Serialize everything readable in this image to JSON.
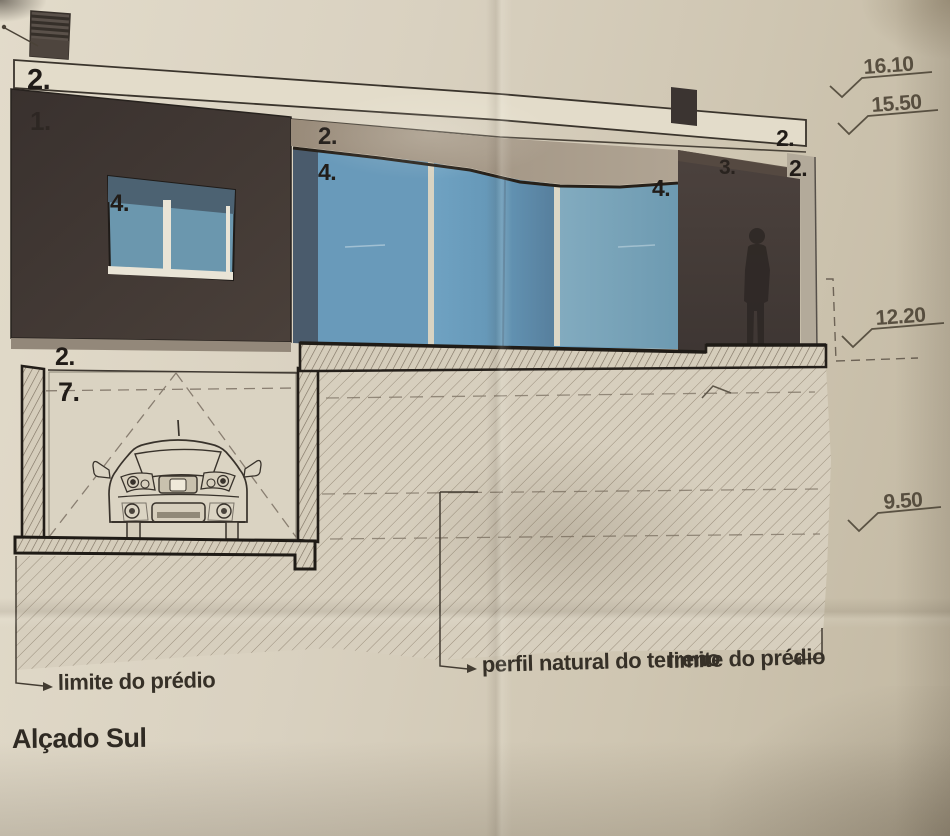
{
  "drawing": {
    "title": "Alçado Sul",
    "legend_labels": {
      "parapet_top": "2.",
      "facade": "1.",
      "window_small": "4.",
      "band_mid": "2.",
      "glazing_left": "4.",
      "glazing_right": "4.",
      "wall_right": "3.",
      "parapet_right": "2.",
      "edge_band_right": "2.",
      "garage_slab": "2.",
      "garage_room": "7."
    },
    "elevations": [
      {
        "value": "16.10"
      },
      {
        "value": "15.50"
      },
      {
        "value": "12.20"
      },
      {
        "value": "9.50"
      }
    ],
    "site_labels": {
      "boundary_left": "limite do prédio",
      "terrain_profile": "perfil natural do terreno",
      "boundary_right": "limite do prédio"
    },
    "colors": {
      "paper": "#d8d0bf",
      "facade_dark": "#3e3632",
      "glass_blue": "#6096b8",
      "band_tan": "#a39584",
      "hatch_line": "#9a8e7c",
      "ink": "#26211c"
    }
  }
}
